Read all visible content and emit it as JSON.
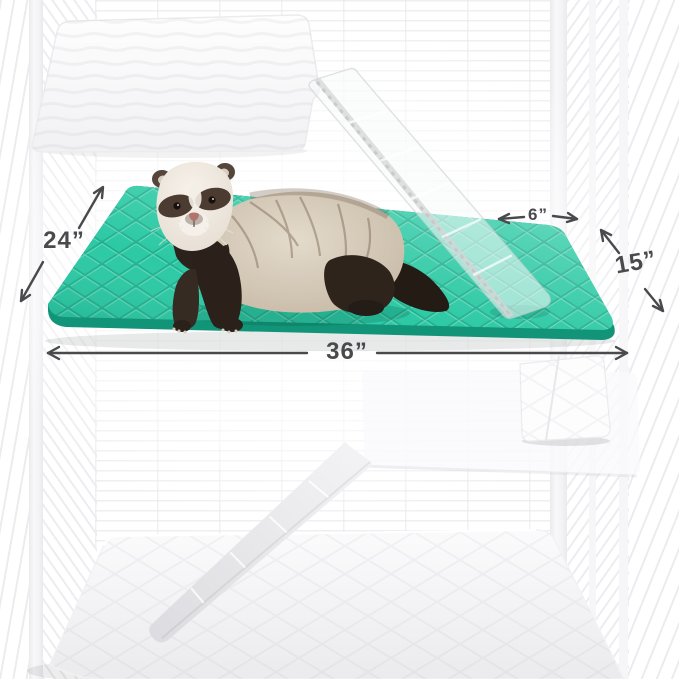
{
  "image": {
    "description": "Ferret standing on a teal quilted cage liner inside a white wire cage; white quilted liners cover the other shelves and fabric ramps connect the levels. Dimension arrows annotate the liner size.",
    "subject": "ferret",
    "product": "quilted cage liner"
  },
  "colors": {
    "background": "#ffffff",
    "mat": "#2cc9a4",
    "mat_edge": "#129479",
    "annotation": "#4a4a4d",
    "cage_line": "#ececef",
    "ferret_dark": "#2b211a",
    "ferret_body": "#d8cfc0"
  },
  "dimension_labels": {
    "left": "24”",
    "bottom": "36”",
    "top_right": "6”",
    "right": "15”"
  }
}
